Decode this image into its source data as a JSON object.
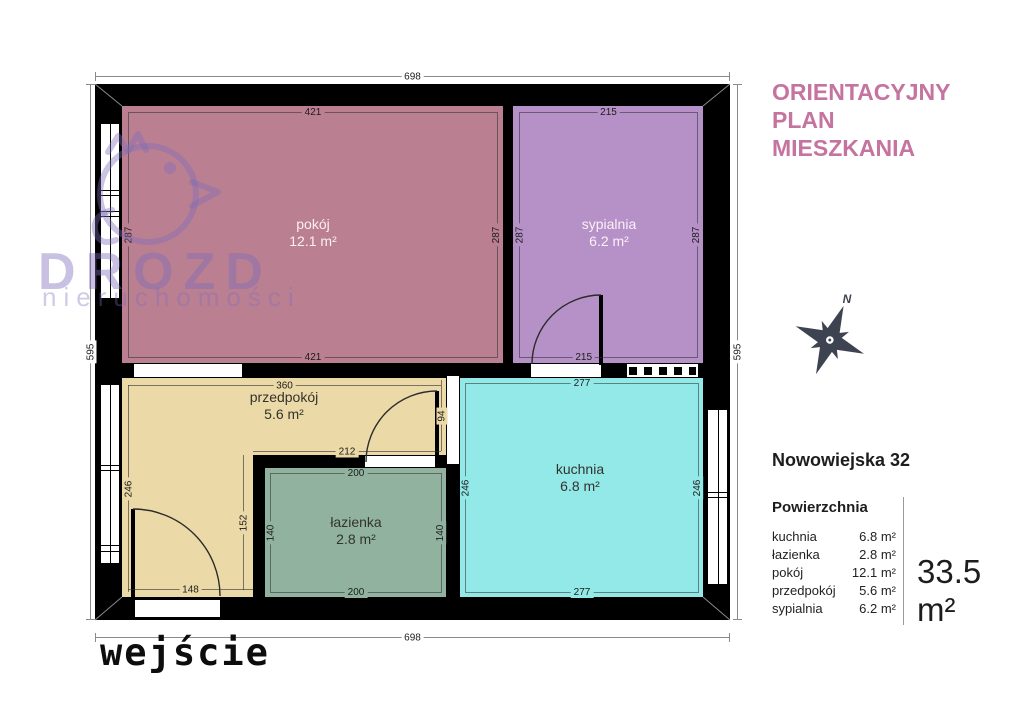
{
  "header": {
    "title_line1": "ORIENTACYJNY",
    "title_line2": "PLAN",
    "title_line3": "MIESZKANIA",
    "title_color": "#c5739f"
  },
  "watermark": {
    "brand": "DROZD",
    "subtitle": "nieruchomości"
  },
  "compass": {
    "north": "N"
  },
  "plan": {
    "entrance_label": "wejście",
    "rooms": {
      "pokoj": {
        "name": "pokój",
        "area": "12.1 m²",
        "color": "#bb7f92"
      },
      "sypialnia": {
        "name": "sypialnia",
        "area": "6.2 m²",
        "color": "#b691c7"
      },
      "przedpokoj": {
        "name": "przedpokój",
        "area": "5.6 m²",
        "color": "#ebdaa7"
      },
      "lazienka": {
        "name": "łazienka",
        "area": "2.8 m²",
        "color": "#90b29f"
      },
      "kuchnia": {
        "name": "kuchnia",
        "area": "6.8 m²",
        "color": "#93e9e7"
      }
    },
    "dims": {
      "outer_top": "698",
      "outer_bottom": "698",
      "outer_left": "595",
      "outer_right": "595",
      "pokoj_top": "421",
      "pokoj_bottom": "421",
      "pokoj_left": "287",
      "pokoj_right": "287",
      "sypialnia_top": "215",
      "sypialnia_bottom": "215",
      "sypialnia_left": "287",
      "sypialnia_right": "287",
      "przedpokoj_top": "360",
      "przedpokoj_left": "246",
      "przedpokoj_mid": "212",
      "przedpokoj_inner": "152",
      "przedpokoj_bottom": "148",
      "przedpokoj_door": "94",
      "lazienka_top": "200",
      "lazienka_bottom": "200",
      "lazienka_left": "140",
      "lazienka_right": "140",
      "kuchnia_top": "277",
      "kuchnia_bottom": "277",
      "kuchnia_left": "246",
      "kuchnia_right": "246"
    },
    "wall_color": "#000000"
  },
  "sidebar": {
    "address": "Nowowiejska 32",
    "table_heading": "Powierzchnia",
    "rows": [
      {
        "room": "kuchnia",
        "area": "6.8 m²"
      },
      {
        "room": "łazienka",
        "area": "2.8 m²"
      },
      {
        "room": "pokój",
        "area": "12.1 m²"
      },
      {
        "room": "przedpokój",
        "area": "5.6 m²"
      },
      {
        "room": "sypialnia",
        "area": "6.2 m²"
      }
    ],
    "total_area": "33.5 m²"
  }
}
